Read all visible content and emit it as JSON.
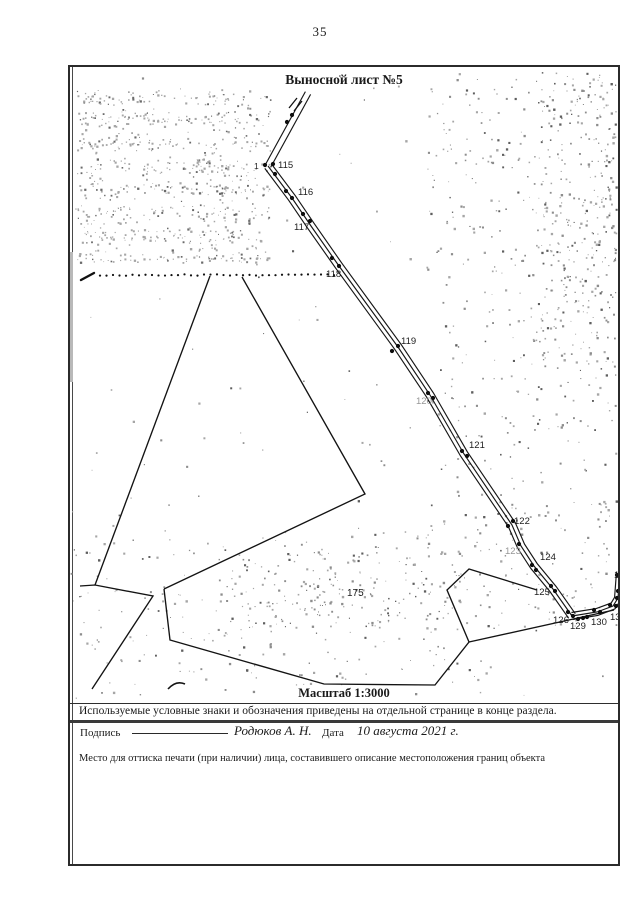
{
  "page": {
    "number": "35"
  },
  "sheet": {
    "title": "Выносной лист №5",
    "scale_label": "Масштаб 1:3000",
    "legend_note": "Используемые условные знаки и обозначения приведены на отдельной странице в конце раздела.",
    "signature": {
      "label": "Подпись",
      "name": "Родюков А. Н.",
      "date_label": "Дата",
      "date_value": "10 августа 2021 г."
    },
    "stamp_note": "Место для оттиска печати (при наличии) лица, составившего описание местоположения границ объекта"
  },
  "colors": {
    "ink": "#1a1a1a",
    "frame": "#2b2b2b",
    "speckle": "#a6a6a6",
    "faint_label": "#969696"
  },
  "map": {
    "roads": [
      {
        "points": [
          [
            238,
            26
          ],
          [
            198,
            99
          ]
        ],
        "offsets": [
          -3,
          3
        ]
      },
      {
        "points": [
          [
            198,
            99
          ],
          [
            222,
            131
          ],
          [
            241,
            159
          ],
          [
            269,
            199
          ],
          [
            328,
            280
          ],
          [
            360,
            328
          ],
          [
            394,
            387
          ],
          [
            442,
            458
          ],
          [
            451,
            479
          ],
          [
            464,
            499
          ],
          [
            483,
            522
          ],
          [
            502,
            549
          ]
        ],
        "offsets": [
          -4,
          0,
          4
        ]
      },
      {
        "points": [
          [
            502,
            549
          ],
          [
            527,
            545
          ],
          [
            543,
            539
          ],
          [
            548,
            531
          ],
          [
            550,
            505
          ]
        ],
        "offsets": [
          -3.5,
          0,
          3.5
        ]
      }
    ],
    "parcel_lines": [
      [
        [
          140,
          209
        ],
        [
          25,
          518
        ]
      ],
      [
        [
          172,
          210
        ],
        [
          295,
          427
        ],
        [
          94,
          522
        ]
      ],
      [
        [
          10,
          519
        ],
        [
          25,
          518
        ],
        [
          83,
          529
        ],
        [
          22,
          622
        ]
      ],
      [
        [
          94,
          522
        ],
        [
          100,
          573
        ],
        [
          254,
          617
        ],
        [
          365,
          618
        ],
        [
          399,
          575
        ],
        [
          377,
          523
        ],
        [
          399,
          502
        ],
        [
          467,
          523
        ]
      ],
      [
        [
          399,
          575
        ],
        [
          544,
          543
        ]
      ]
    ],
    "squiggle": "M 98,622 Q 106,613 115,617",
    "dotted_line": {
      "y": 208,
      "x1": 30,
      "x2": 266,
      "spacing": 6.5,
      "r": 1.1,
      "tick": [
        [
          11,
          213
        ],
        [
          24,
          206
        ]
      ]
    },
    "break_marks": [
      [
        [
          219,
          41
        ],
        [
          227,
          31
        ]
      ],
      [
        [
          224,
          44
        ],
        [
          232,
          34
        ]
      ]
    ],
    "dots": [
      [
        217,
        55
      ],
      [
        222,
        48
      ],
      [
        195,
        98
      ],
      [
        203,
        97
      ],
      [
        205,
        107
      ],
      [
        216,
        124
      ],
      [
        222,
        131
      ],
      [
        233,
        147
      ],
      [
        240,
        154
      ],
      [
        262,
        191
      ],
      [
        269,
        199
      ],
      [
        322,
        284
      ],
      [
        328,
        279
      ],
      [
        358,
        326
      ],
      [
        363,
        331
      ],
      [
        392,
        384
      ],
      [
        397,
        389
      ],
      [
        438,
        459
      ],
      [
        443,
        454
      ],
      [
        449,
        477
      ],
      [
        462,
        498
      ],
      [
        466,
        503
      ],
      [
        481,
        519
      ],
      [
        485,
        524
      ],
      [
        498,
        545
      ],
      [
        503,
        549
      ],
      [
        508,
        552
      ],
      [
        513,
        551
      ],
      [
        517,
        550
      ],
      [
        524,
        543
      ],
      [
        530,
        545
      ],
      [
        540,
        538
      ],
      [
        546,
        539
      ],
      [
        547,
        531
      ],
      [
        548,
        524
      ],
      [
        547,
        508
      ]
    ],
    "point_labels": [
      {
        "t": "1",
        "x": 184,
        "y": 102,
        "s": 8.5
      },
      {
        "t": "115",
        "x": 208,
        "y": 101
      },
      {
        "t": "116",
        "x": 228,
        "y": 128
      },
      {
        "t": "117",
        "x": 224,
        "y": 163
      },
      {
        "t": "118",
        "x": 256,
        "y": 210
      },
      {
        "t": "119",
        "x": 331,
        "y": 277
      },
      {
        "t": "120",
        "x": 346,
        "y": 337,
        "faint": true
      },
      {
        "t": "121",
        "x": 399,
        "y": 381
      },
      {
        "t": "122",
        "x": 444,
        "y": 457
      },
      {
        "t": "123",
        "x": 435,
        "y": 487,
        "faint": true
      },
      {
        "t": "124",
        "x": 470,
        "y": 493
      },
      {
        "t": "125",
        "x": 464,
        "y": 528
      },
      {
        "t": "126",
        "x": 483,
        "y": 556
      },
      {
        "t": "129",
        "x": 500,
        "y": 562
      },
      {
        "t": "130",
        "x": 521,
        "y": 558
      },
      {
        "t": "131",
        "x": 540,
        "y": 553
      },
      {
        "t": "132",
        "x": 544,
        "y": 511
      },
      {
        "t": "175",
        "x": 277,
        "y": 529,
        "s": 10
      }
    ]
  }
}
